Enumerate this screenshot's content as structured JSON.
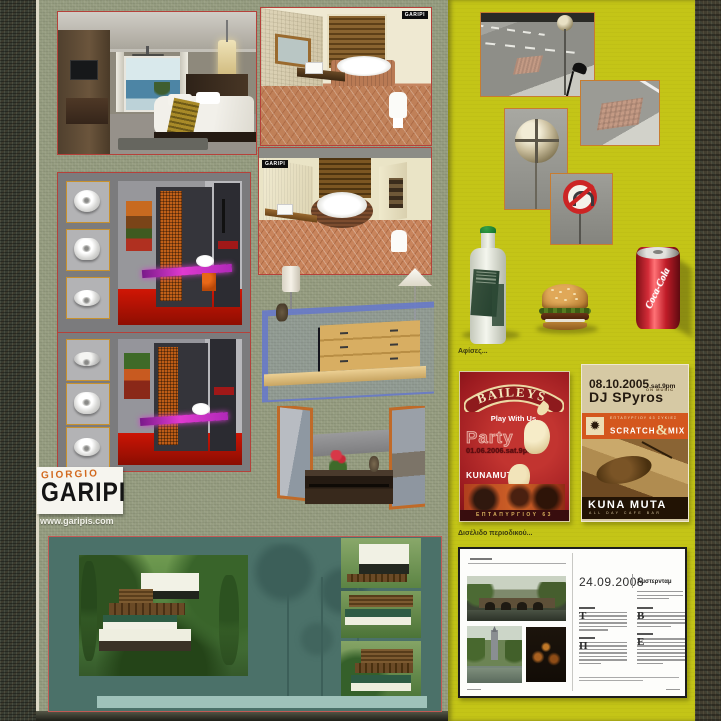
{
  "logo": {
    "giorgio": "GIORGIO",
    "garipi": "GARIPI",
    "website": "www.garipis.com"
  },
  "watermarks": {
    "bathroom1": "GARIPI",
    "bathroom2": "GARIPI"
  },
  "captions": {
    "posters": "Αφίσες...",
    "magazine": "Δισέλιδο περιοδικού..."
  },
  "posters": {
    "baileys": {
      "brand": "BAILEYS",
      "tagline": "Play With Us.",
      "title": "Party",
      "datetime": "01.06.2006.sat.9pm",
      "venue": "KUNAMUTA",
      "address": "ΕΠΤΑΠΥΡΓΙΟΥ 63 ΣΥΚΙΕΣ"
    },
    "dj": {
      "date": "08.10.2005",
      "date_suffix": ".sat.9pm",
      "artist": "DJ SPyros",
      "artist_note": "ON MUSIC",
      "address": "ΕΠΤΑΠΥΡΓΙΟΥ 63 ΣΥΚΙΕΣ",
      "scratch": "SCRATCH",
      "amp": "&",
      "mix": "MIX",
      "venue": "KUNA MUTA",
      "venue_sub": "ALL DAY CAFE BAR"
    }
  },
  "products": {
    "cola_script": "Coca-Cola"
  },
  "magazine": {
    "date": "24.09.2008",
    "title": "Αμστερνταμ",
    "dropcaps": [
      "Τ",
      "Β",
      "Π",
      "Ε"
    ]
  },
  "colors": {
    "canvas_green": "#939a7e",
    "panel_yellow": "#c4c517",
    "border_red": "#b5413a",
    "border_orange": "#c77c30",
    "villa_teal": "#4b7169",
    "baileys_red": "#9c1b20",
    "dj_orange": "#d4571e",
    "cola_red": "#c6202a"
  }
}
